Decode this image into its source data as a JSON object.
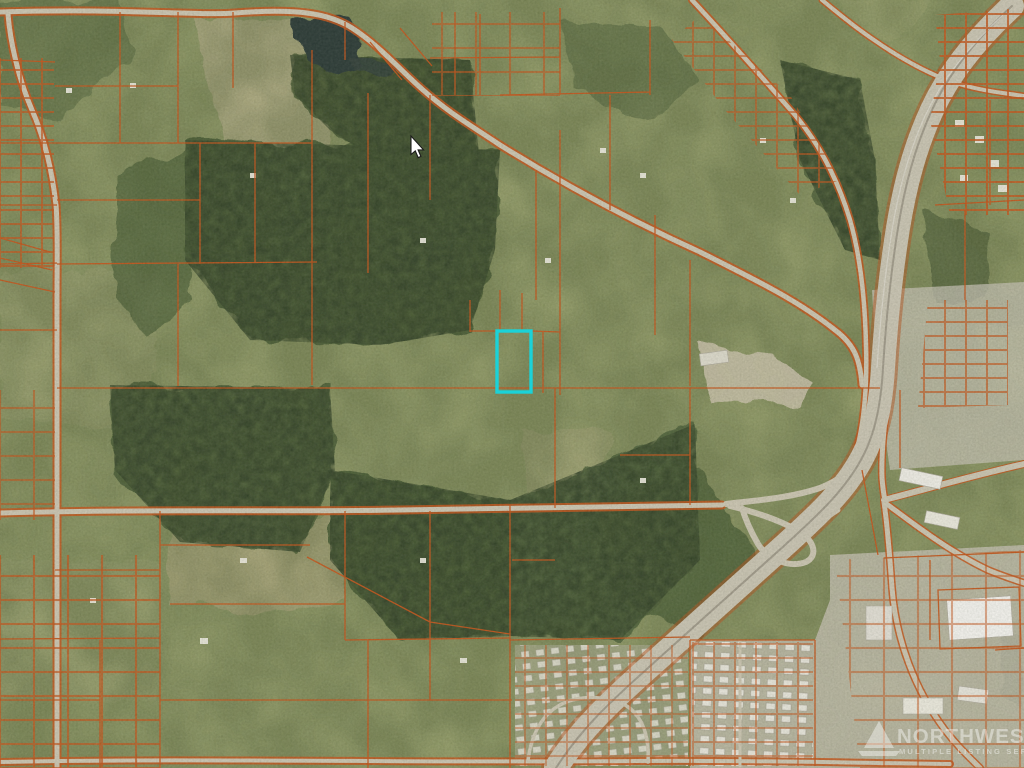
{
  "map": {
    "description": "Aerial photo parcel map with orange parcel boundary overlay",
    "base_color": "#97a06c",
    "field_color": "#b7b189",
    "field_color_light": "#aaab7d",
    "forest_color": "#4e6039",
    "forest_speckle_color": "#36452b",
    "water_color": "#2f3e38",
    "road_color": "#cdc7b3",
    "highway_color": "#cbc6b4",
    "highway_median_color": "#a29c8c",
    "urban_color": "#c6c2b3",
    "gravel_color": "#c6bfa6",
    "parcel_line_color": "#c5581e",
    "building_color": "#f0eee6",
    "highlight": {
      "color": "#1bd2d8",
      "x": 497,
      "y": 331,
      "width": 34,
      "height": 61,
      "stroke_width": 3.4
    },
    "cursor": {
      "transform": "translate(411,136)",
      "fill": "#ffffff",
      "outline": "#1c1c1c"
    }
  },
  "watermark": {
    "line1": "NORTHWEST",
    "line2": "MULTIPLE LISTING SERVICE",
    "color": "#ffffff",
    "opacity": 0.42
  }
}
